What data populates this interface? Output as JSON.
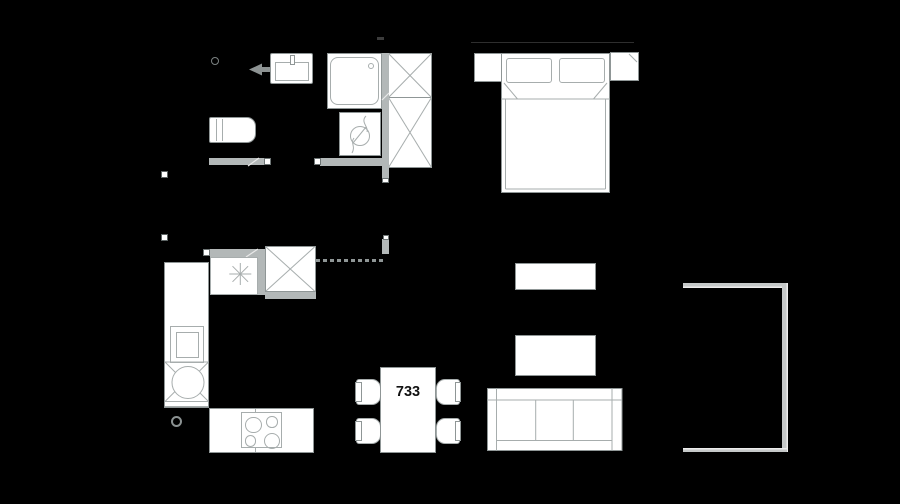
{
  "plan": {
    "apartment_number": "733"
  },
  "colors": {
    "background": "#000000",
    "furniture_fill": "#ffffff",
    "line_strong": "#8f9696",
    "line_light": "#a7adad",
    "wall": "#b3b8b8",
    "wall_dark": "#8d9393",
    "cap_border": "#6e7575",
    "railing": "#c5c8c8",
    "faint": "#2e2e2e",
    "text": "#111111"
  },
  "items": {
    "bathroom": [
      "entrance-arrow",
      "washbasin",
      "shower",
      "washing-machine",
      "toilet",
      "wardrobe"
    ],
    "bedroom": [
      "double-bed",
      "pillows",
      "nightstand-left",
      "nightstand-right"
    ],
    "kitchen": [
      "kitchen-counter",
      "fridge",
      "tall-cabinet",
      "oven",
      "round-sink",
      "hob-4-burners",
      "floor-drain"
    ],
    "dining": [
      "dining-table",
      "chairs-4"
    ],
    "living": [
      "tv-stand",
      "coffee-table",
      "sofa"
    ],
    "outdoor": [
      "balcony-railing"
    ]
  }
}
